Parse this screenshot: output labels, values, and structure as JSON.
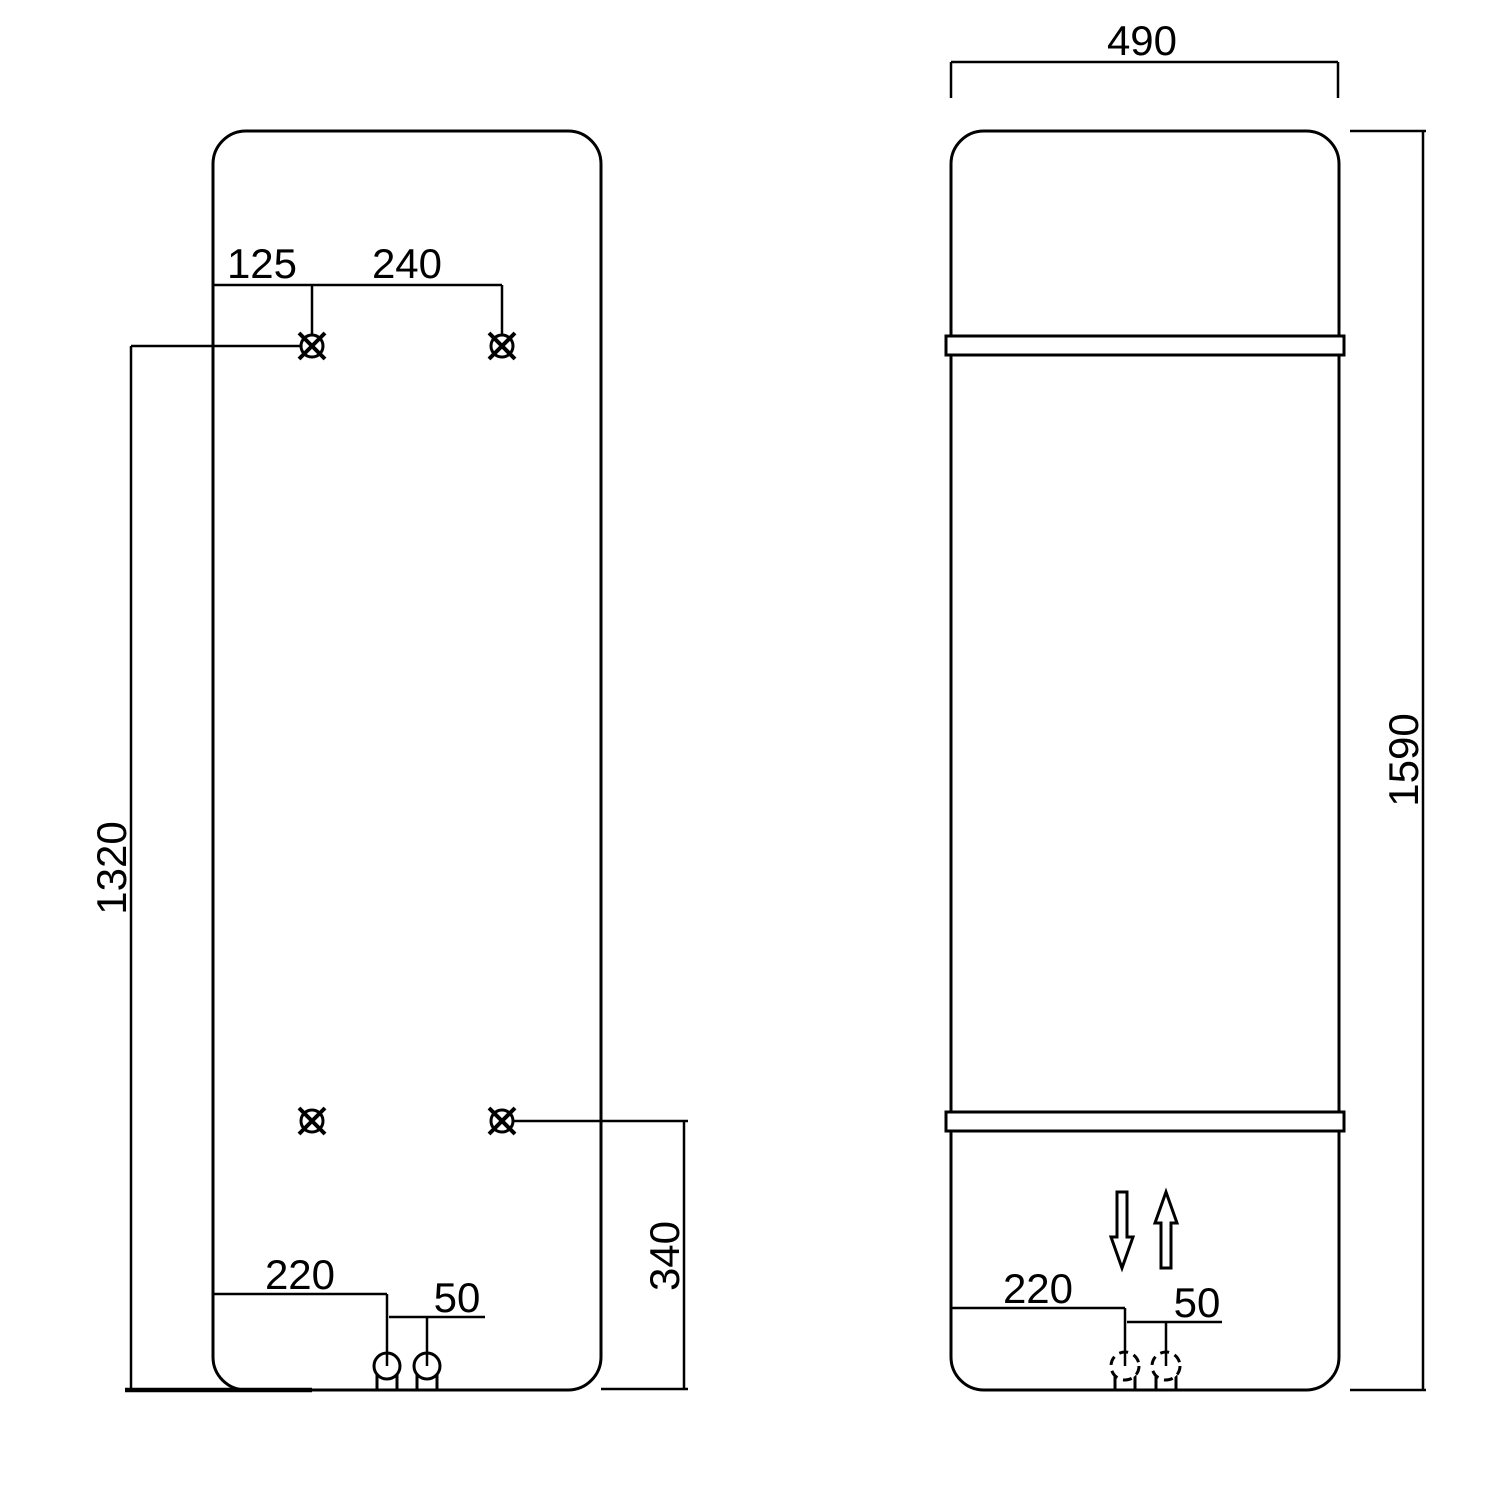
{
  "drawing": {
    "kind": "radiator-installation-dimension-drawing",
    "background_color": "#ffffff",
    "line_color": "#000000",
    "views": {
      "rear": {
        "label": "rear-mounting-view",
        "dims": {
          "bracket_offset_left": "125",
          "bracket_spacing": "240",
          "upper_brackets_from_bottom": "1320",
          "lower_brackets_from_bottom": "340",
          "pipe_offset_left": "220",
          "pipe_spacing": "50"
        }
      },
      "front": {
        "label": "front-view",
        "dims": {
          "overall_width": "490",
          "overall_height": "1590",
          "pipe_offset_left": "220",
          "pipe_spacing": "50"
        }
      }
    }
  }
}
